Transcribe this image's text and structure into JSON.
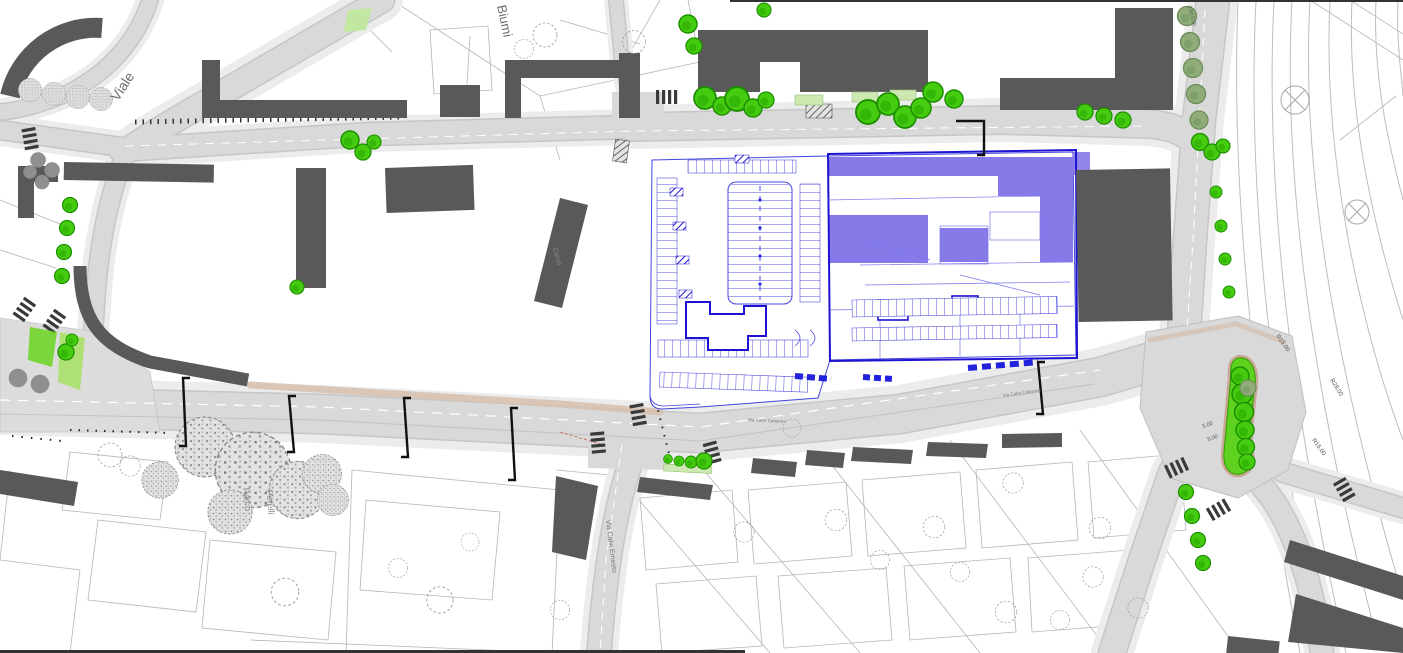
{
  "plan": {
    "labels": {
      "streets": [
        {
          "id": "viale",
          "text": "Viale",
          "x": 118,
          "y": 102,
          "rotate": -57,
          "size": 14,
          "color": "#6e6e6e"
        },
        {
          "id": "biumi",
          "text": "Biumi",
          "x": 497,
          "y": 6,
          "rotate": 78,
          "size": 13,
          "color": "#6e6e6e"
        },
        {
          "id": "caroli",
          "text": "Caroli",
          "x": 553,
          "y": 248,
          "rotate": 76,
          "size": 7,
          "color": "#8a8a8a"
        },
        {
          "id": "via-calvi-ernesto",
          "text": "Via Calvi Ernesto",
          "x": 606,
          "y": 520,
          "rotate": 83,
          "size": 7,
          "color": "#7a7a7a"
        },
        {
          "id": "via-carlo-cattaneo-w",
          "text": "Via Carlo Cattaneo",
          "x": 748,
          "y": 421,
          "rotate": 3,
          "size": 4.5,
          "color": "#7a7a7a"
        },
        {
          "id": "via-carlo-cattaneo-e",
          "text": "Via Carlo Cattaneo",
          "x": 1003,
          "y": 397,
          "rotate": -8,
          "size": 4.5,
          "color": "#7a7a7a"
        }
      ],
      "places": [
        {
          "id": "parco",
          "text": "Parco",
          "x": 243,
          "y": 488,
          "rotate": 84,
          "size": 9,
          "color": "#8a8a8a"
        },
        {
          "id": "perelli",
          "text": "Perelli",
          "x": 266,
          "y": 490,
          "rotate": 84,
          "size": 9,
          "color": "#8a8a8a"
        }
      ],
      "dimensions": [
        {
          "id": "r15-top",
          "text": "R15,00",
          "x": 1276,
          "y": 336,
          "rotate": 55,
          "size": 6,
          "color": "#555555"
        },
        {
          "id": "r28",
          "text": "R28,00",
          "x": 1330,
          "y": 380,
          "rotate": 58,
          "size": 6,
          "color": "#555555"
        },
        {
          "id": "r15-bottom",
          "text": "R15,00",
          "x": 1312,
          "y": 440,
          "rotate": 55,
          "size": 6,
          "color": "#555555"
        },
        {
          "id": "dim-5",
          "text": "5,00",
          "x": 1203,
          "y": 428,
          "rotate": -18,
          "size": 5.5,
          "color": "#555555"
        },
        {
          "id": "dim-8",
          "text": "8,00",
          "x": 1208,
          "y": 441,
          "rotate": -18,
          "size": 5.5,
          "color": "#555555"
        },
        {
          "id": "dim-top-right",
          "text": "2,50  5,00",
          "x": 1188,
          "y": 6,
          "rotate": 75,
          "size": 5,
          "color": "#555555"
        }
      ]
    },
    "colors": {
      "project_fill": "#8679e8",
      "project_line_bold": "#1d12cf",
      "project_line_thin": "#4444dd",
      "tree_green": "#45cc10",
      "tree_green_dark": "#1d8f00",
      "tree_sage": "#8fac79",
      "building_gray": "#595959",
      "road_gray": "#d9d9d9",
      "sidewalk_gray": "#ececec",
      "island_green": "#5ed21e",
      "island_ring": "#c9a795",
      "label_default": "#777777"
    }
  }
}
